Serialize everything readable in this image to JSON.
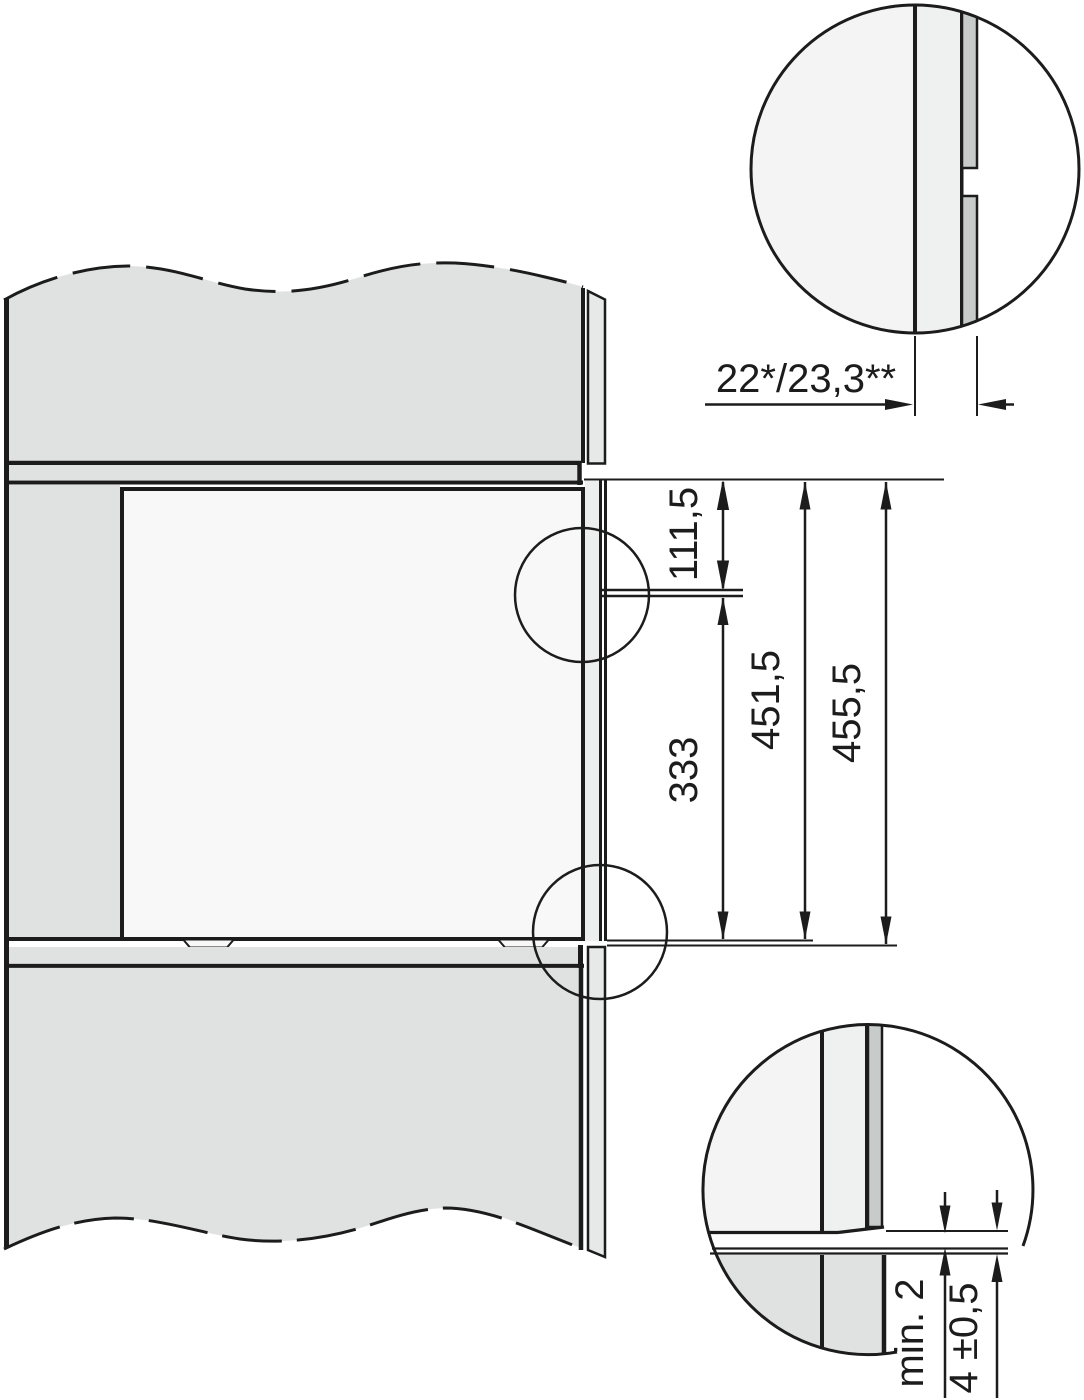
{
  "title": "Built-in appliance niche installation drawing (side section)",
  "units": "mm",
  "labels": {
    "panel_thickness": "22*/23,3**",
    "top_to_seam": "111,5",
    "seam_to_bottom": "333",
    "niche_height": "451,5",
    "overall_height": "455,5",
    "min_clearance": "min. 2",
    "bottom_gap": "4 ±0,5"
  },
  "colors": {
    "line": "#1c1c1c",
    "background": "#ffffff",
    "cabinet_gray": "#e0e2e1",
    "sliver_gray": "#e7e9e8",
    "oven_side_gray": "#edefee",
    "niche_white": "#f7f8f7",
    "detail_bg": "#f3f4f3",
    "detail_mid": "#eff1f0",
    "trim_gray": "#c7cbca"
  }
}
